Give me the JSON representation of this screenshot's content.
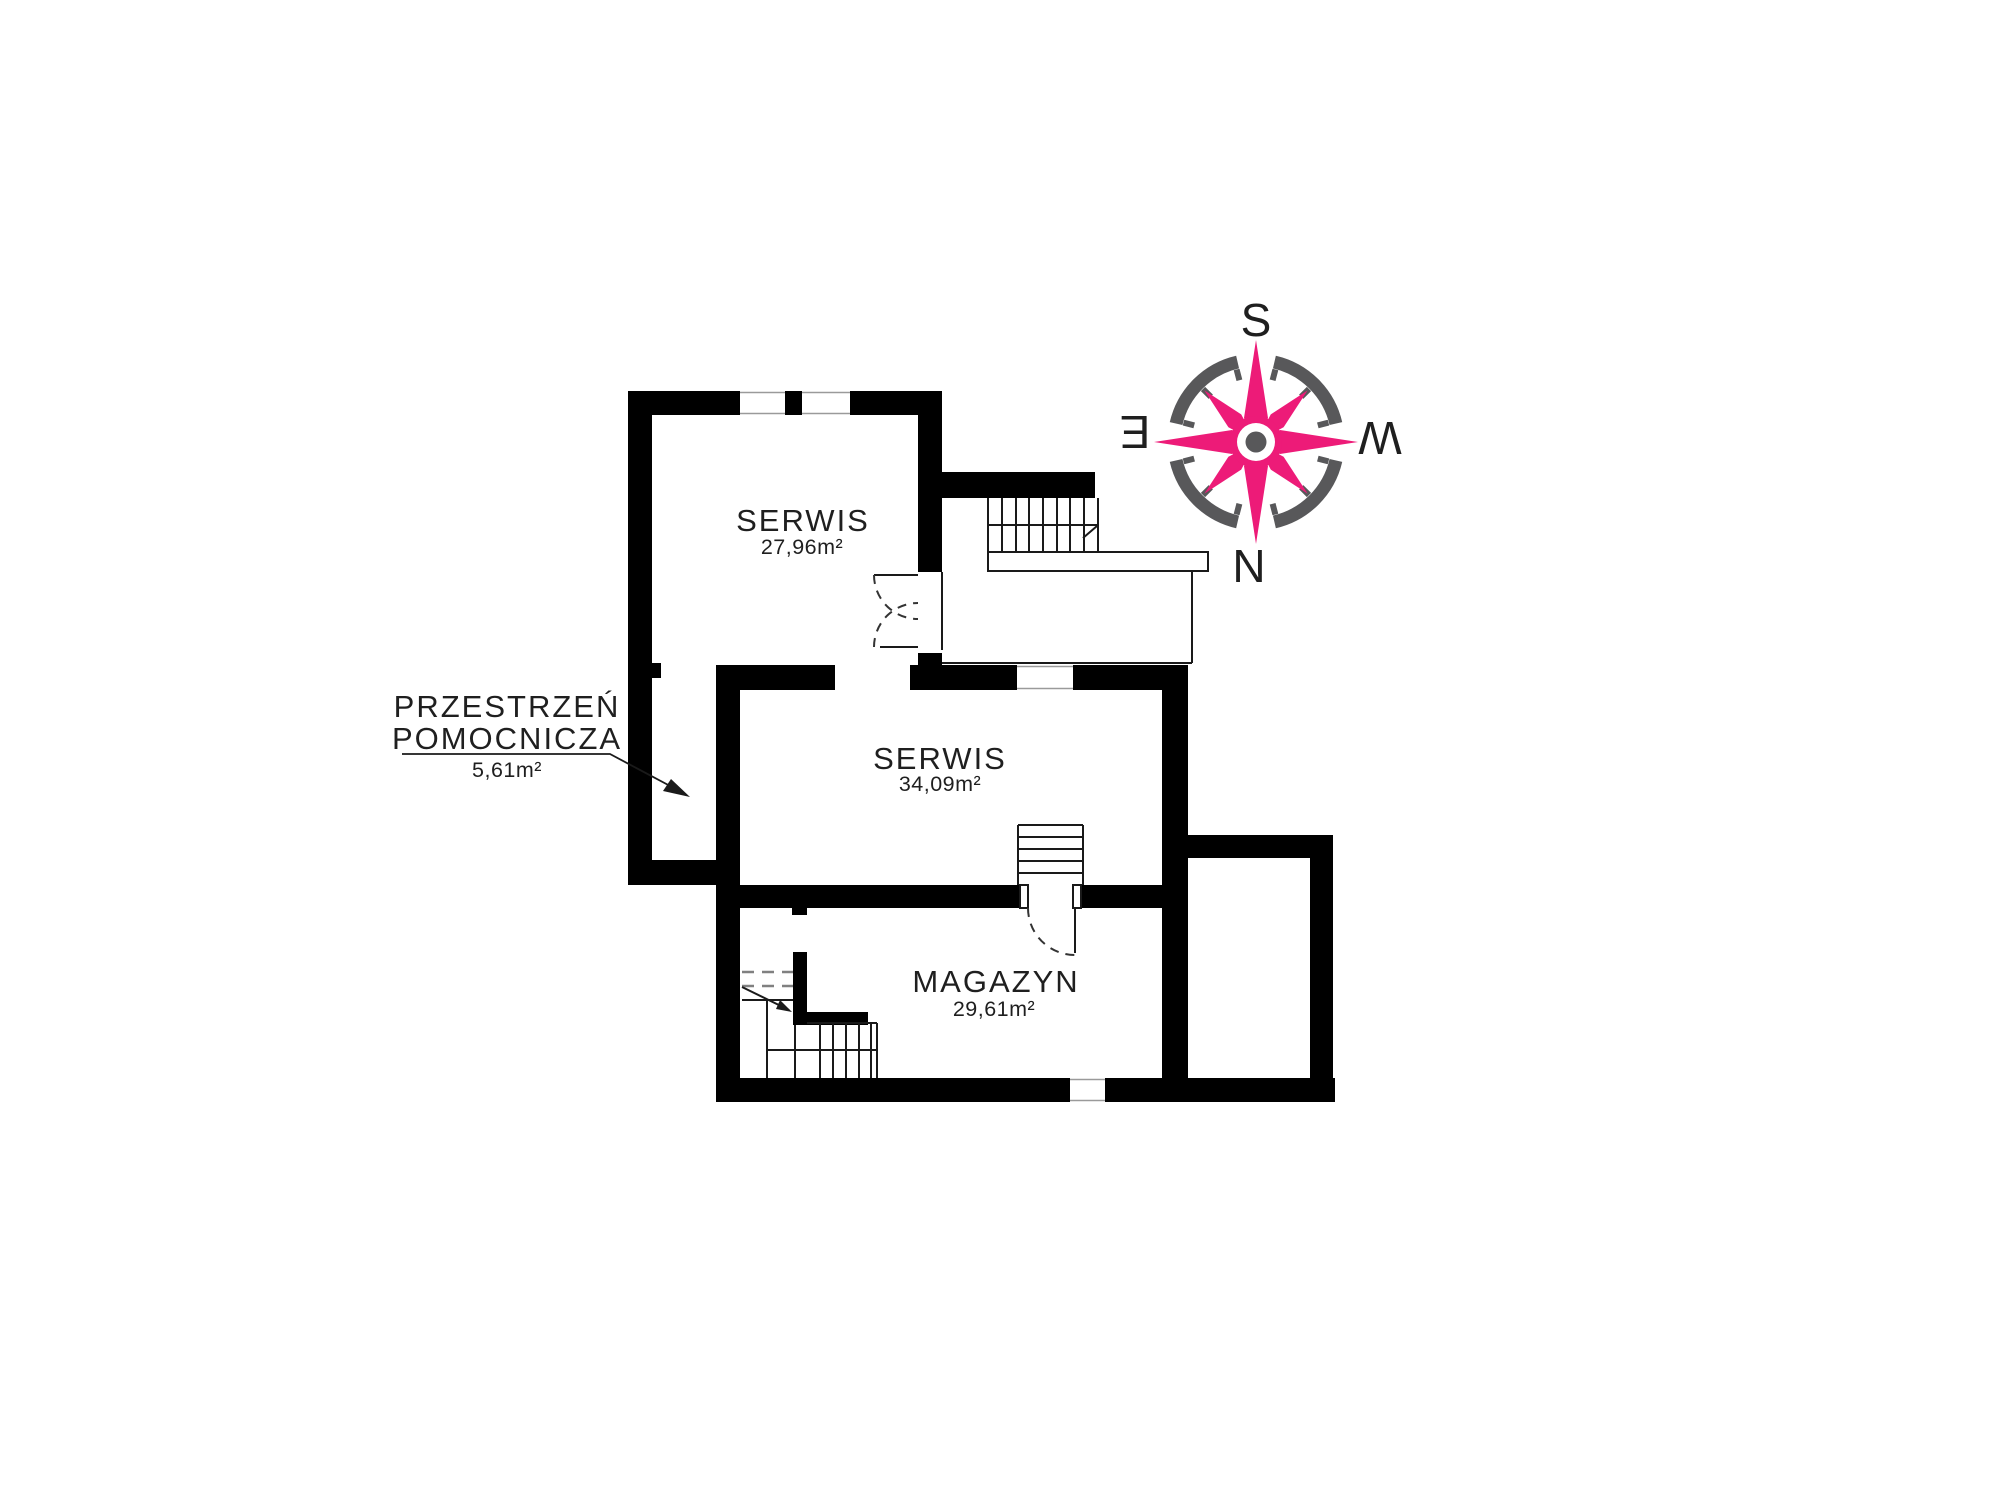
{
  "plan": {
    "rooms": [
      {
        "id": "serwis-1",
        "name": "SERWIS",
        "area": "27,96m²"
      },
      {
        "id": "serwis-2",
        "name": "SERWIS",
        "area": "34,09m²"
      },
      {
        "id": "magazyn",
        "name": "MAGAZYN",
        "area": "29,61m²"
      }
    ],
    "aux_space": {
      "name_line1": "PRZESTRZEŃ",
      "name_line2": "POMOCNICZA",
      "area": "5,61m²"
    }
  },
  "compass": {
    "top": "S",
    "bottom": "N",
    "left": "E",
    "right": "W"
  },
  "colors": {
    "wall": "#000000",
    "line": "#1a1a1a",
    "text": "#1f1f1f",
    "pink": "#ED1B78",
    "gray": "#58585A",
    "background": "#FFFFFF"
  }
}
